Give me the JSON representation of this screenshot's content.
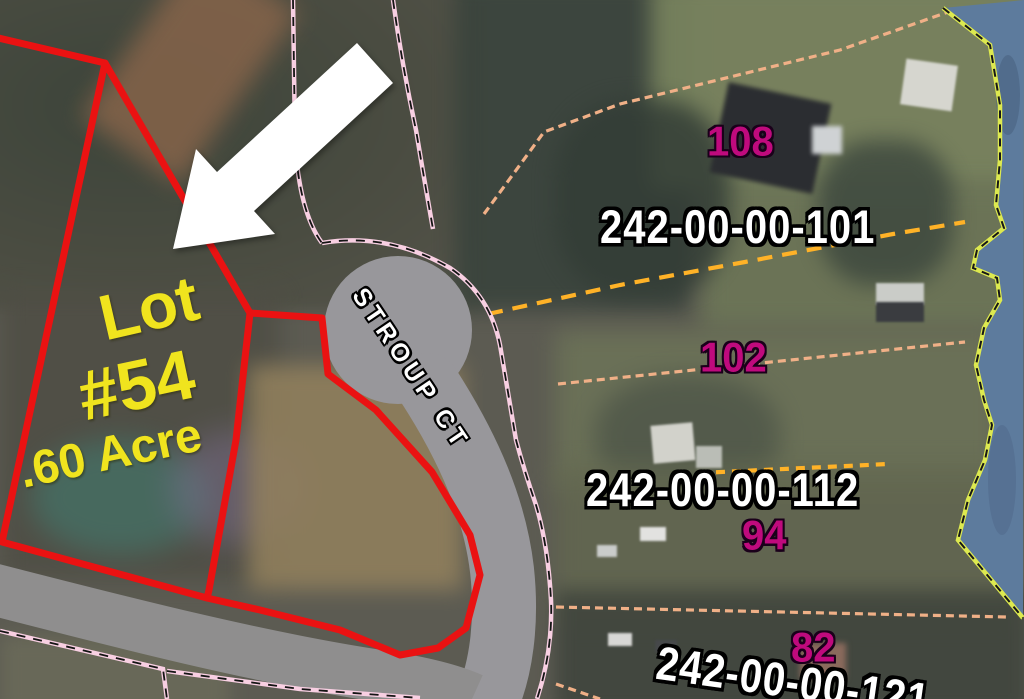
{
  "map": {
    "featured_lot": {
      "word": "Lot",
      "number": "#54",
      "acreage": ".60 Acre"
    },
    "street": {
      "name": "STROUP CT"
    },
    "parcels": [
      {
        "parcel_id": "242-00-00-101",
        "house_number": "108"
      },
      {
        "parcel_id": "",
        "house_number": "102"
      },
      {
        "parcel_id": "242-00-00-112",
        "house_number": "94"
      },
      {
        "parcel_id": "242-00-00-121",
        "house_number": "82"
      }
    ],
    "colors": {
      "lot_boundary": "#ea1212",
      "lot_text": "#f0e41e",
      "house_number_text": "#bf0a7d",
      "parcel_id_text": "#ffffff",
      "right_of_way_line": "#f8cfe2",
      "parcel_line": "#f0b087",
      "boundary_dashed": "#ffb227",
      "shoreline": "#dde94f",
      "water": "#5d7b9d",
      "road": "#98979b",
      "arrow": "#ffffff"
    }
  }
}
